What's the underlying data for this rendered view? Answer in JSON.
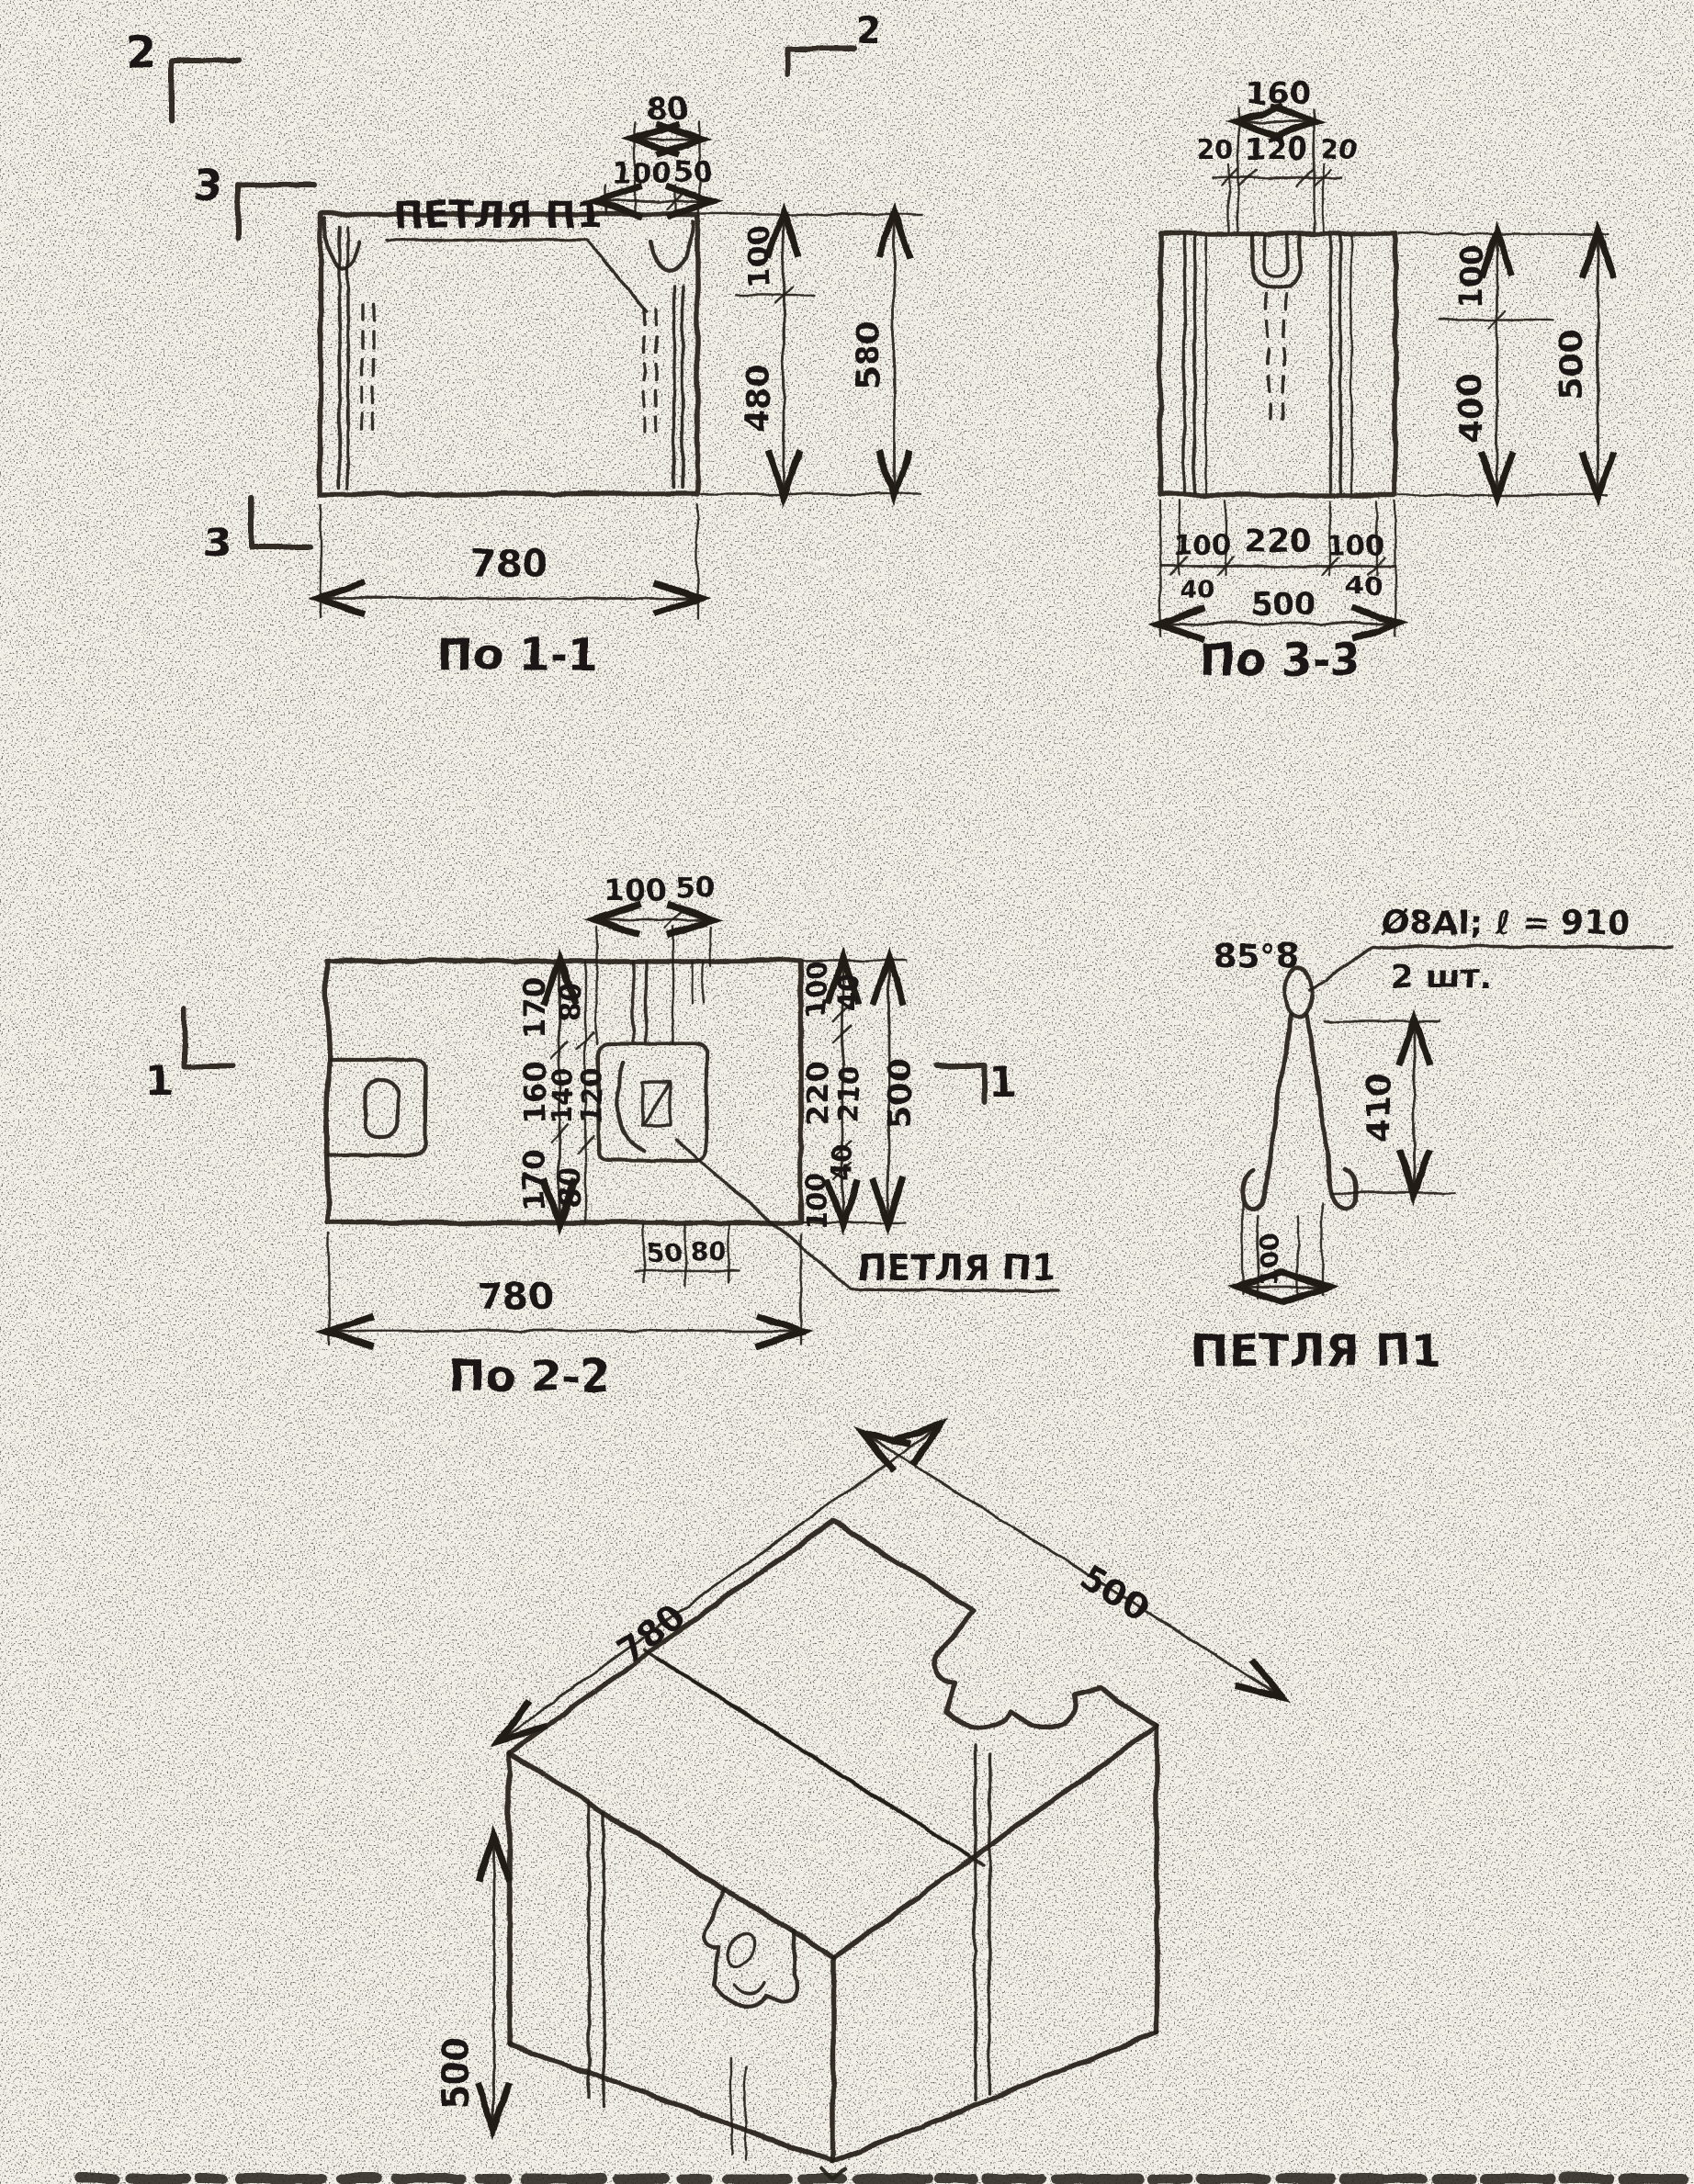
{
  "paper": {
    "bg": "#f2efe7",
    "ink": "#1b1813"
  },
  "markers": {
    "sec2a": "2",
    "sec2b": "2",
    "sec3a": "3",
    "sec3b": "3",
    "sec1a": "1",
    "sec1b": "1"
  },
  "view11": {
    "caption": "По 1-1",
    "petlya": "ПЕТЛЯ П1",
    "d80": "80",
    "d100t": "100",
    "d50": "50",
    "d100r": "100",
    "d480": "480",
    "d580": "580",
    "d780": "780"
  },
  "view33": {
    "caption": "По 3-3",
    "d160": "160",
    "d20a": "20",
    "d120": "120",
    "d20b": "20",
    "d100r": "100",
    "d400": "400",
    "d500r": "500",
    "d100a": "100",
    "d220": "220",
    "d100b": "100",
    "d40a": "40",
    "d40b": "40",
    "d500b": "500"
  },
  "view22": {
    "caption": "По 2-2",
    "petlya": "ПЕТЛЯ П1",
    "d100t": "100",
    "d50t": "50",
    "c170a": "170",
    "c160": "160",
    "c170b": "170",
    "c80a": "80",
    "c140": "140",
    "c120": "120",
    "c80b": "80",
    "r100a": "100",
    "r40a": "40",
    "r220": "220",
    "r210": "210",
    "r40b": "40",
    "r100b": "100",
    "r500": "500",
    "n50": "50",
    "n80": "80",
    "d780": "780"
  },
  "loopDetail": {
    "caption": "ПЕТЛЯ П1",
    "corner": "85°8",
    "note1": "Ø8АI; ℓ = 910",
    "note2": "2 шт.",
    "d410": "410",
    "d100": "100"
  },
  "iso": {
    "d780": "780",
    "d500depth": "500",
    "d500height": "500"
  }
}
